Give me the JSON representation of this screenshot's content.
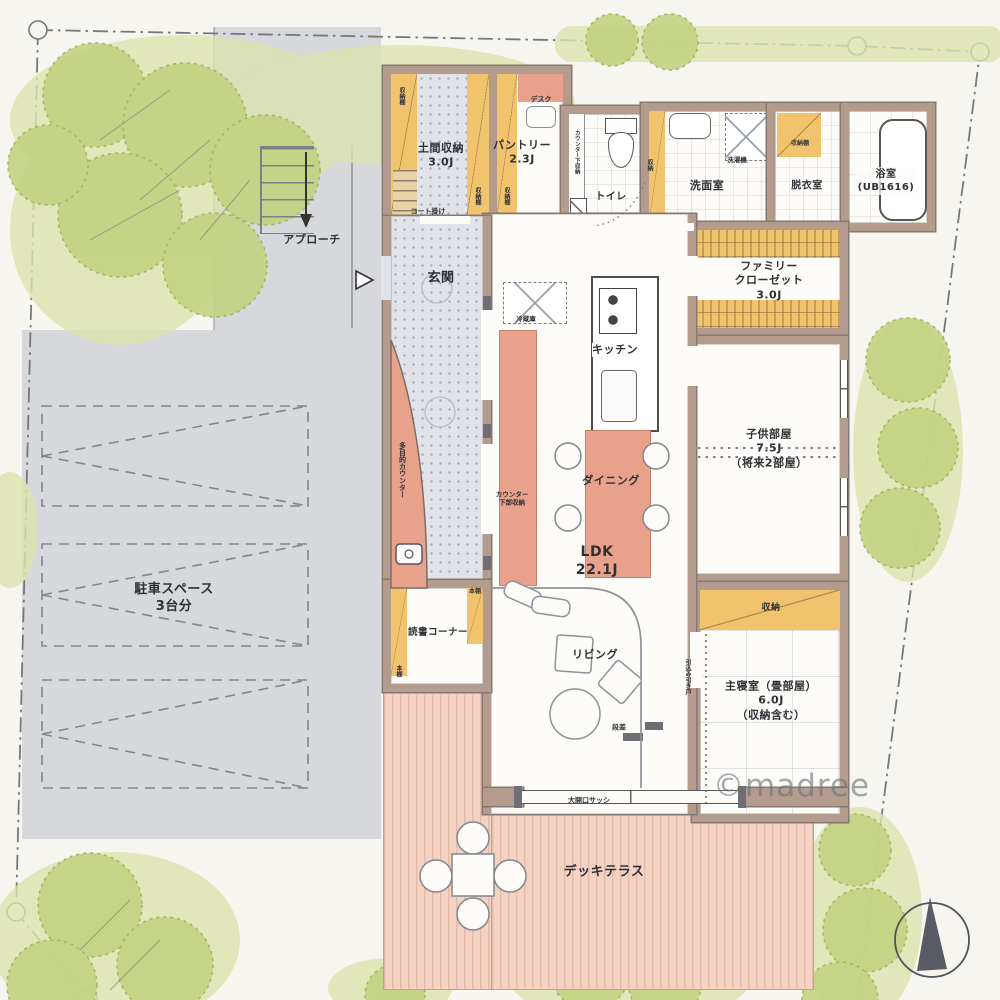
{
  "watermark": "©madree",
  "colors": {
    "paper": "#f7f5f0",
    "wall": "#b39c8e",
    "floor": "#fdfcf9",
    "gray": "#d6d8dc",
    "stipple": "#e1e3e8",
    "orange": "#f2c36d",
    "red": "#e8a28b",
    "deck": "#f4d3c4",
    "greenLight": "#dce3ae",
    "greenMid": "#c3d282",
    "greenDark": "#9db25c",
    "ink": "#2f3035"
  },
  "site": {
    "parking_label": "駐車スペース\n3台分",
    "approach_label": "アプローチ",
    "deck_label": "デッキテラス",
    "sash_label": "大開口サッシ"
  },
  "rooms": {
    "doma": {
      "label": "土間収納\n3.0J"
    },
    "pantry": {
      "label": "パントリー\n2.3J"
    },
    "toilet": {
      "label": "トイレ"
    },
    "washroom": {
      "label": "洗面室"
    },
    "dressing": {
      "label": "脱衣室"
    },
    "bath": {
      "label": "浴室\n(UB1616)"
    },
    "family_closet": {
      "label": "ファミリー\nクローゼット\n3.0J"
    },
    "entrance": {
      "label": "玄関"
    },
    "ldk": {
      "label": "LDK\n22.1J"
    },
    "kitchen": {
      "label": "キッチン"
    },
    "dining": {
      "label": "ダイニング"
    },
    "living": {
      "label": "リビング"
    },
    "kids": {
      "label": "子供部屋\n7.5J\n（将来2部屋）"
    },
    "reading": {
      "label": "読書コーナー"
    },
    "master": {
      "label": "主寝室（畳部屋）\n6.0J\n（収納含む）"
    },
    "master_storage": {
      "label": "収納"
    }
  },
  "fixtures": {
    "desk": "デスク",
    "coat_hook": "コート掛け",
    "shelf": "収納棚",
    "washer": "洗濯機",
    "fridge": "冷蔵庫",
    "storage": "収納",
    "counter_under_toilet": "カウンター下収納",
    "counter_under_kitchen": "カウンター\n下部収納",
    "multi_counter": "多目的カウンター",
    "bookshelf": "本棚",
    "sliding_door": "引込み引き戸",
    "step": "段差"
  }
}
